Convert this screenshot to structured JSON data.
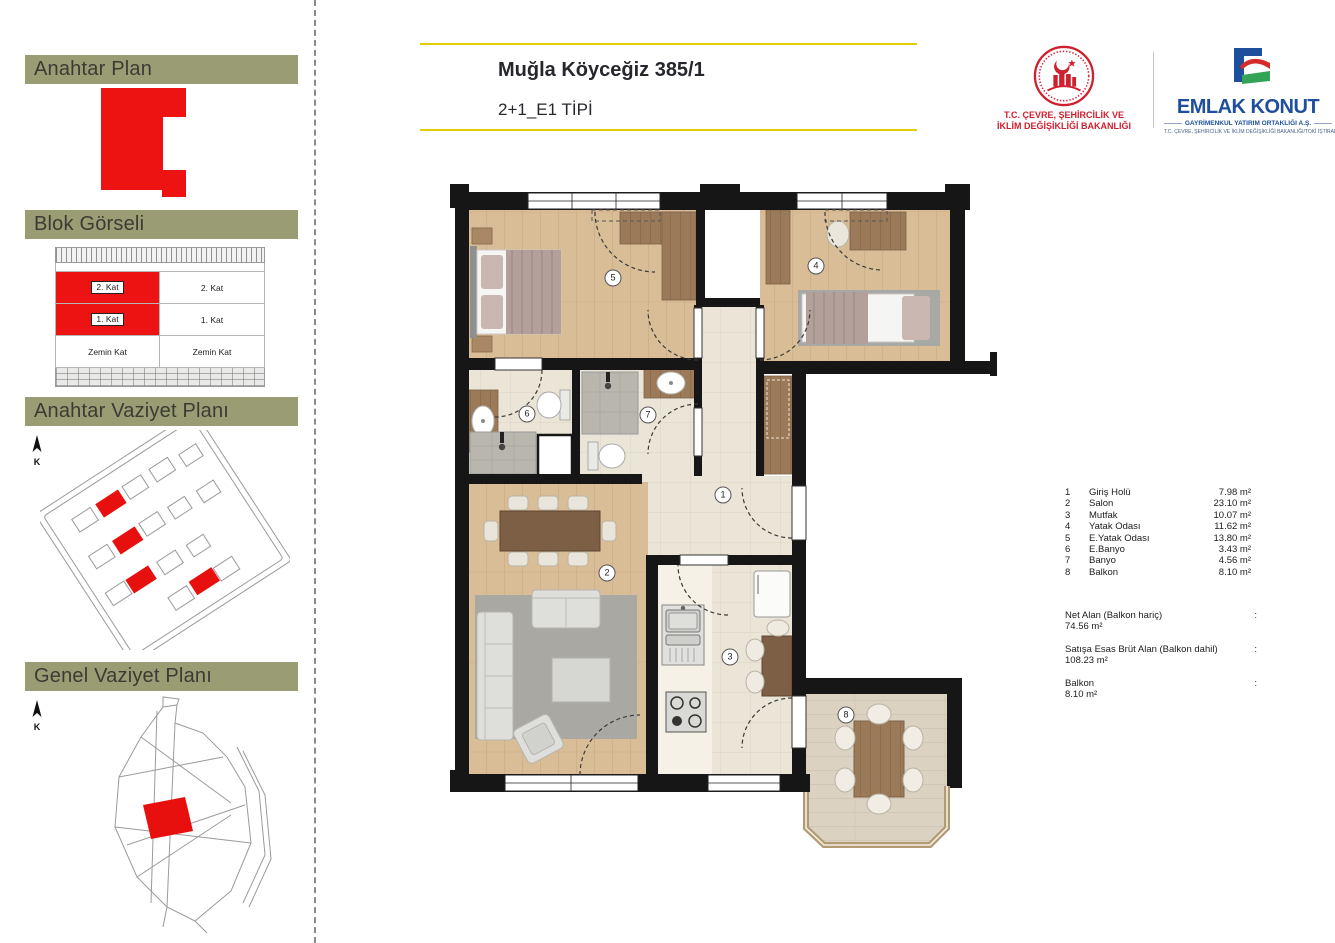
{
  "header": {
    "title": "Muğla Köyceğiz 385/1",
    "subtitle": "2+1_E1 TİPİ"
  },
  "logos": {
    "ministry": {
      "line1": "T.C. ÇEVRE, ŞEHİRCİLİK VE",
      "line2": "İKLİM DEĞİŞİKLİĞİ BAKANLIĞI"
    },
    "emlak": {
      "name": "EMLAK KONUT",
      "subtitle": "GAYRİMENKUL YATIRIM ORTAKLIĞI A.Ş.",
      "tagline": "T.C. ÇEVRE, ŞEHİRCİLİK VE İKLİM DEĞİŞİKLİĞİ BAKANLIĞI/TOKİ İŞTİRAKİDİR"
    }
  },
  "sidebar": {
    "north_label": "K",
    "sections": [
      {
        "title": "Anahtar Plan"
      },
      {
        "title": "Blok Görseli"
      },
      {
        "title": "Anahtar Vaziyet Planı"
      },
      {
        "title": "Genel Vaziyet Planı"
      }
    ],
    "blok": {
      "left_col": [
        "2. Kat",
        "1. Kat",
        "Zemin Kat"
      ],
      "right_col": [
        "2. Kat",
        "1. Kat",
        "Zemin Kat"
      ]
    }
  },
  "plan": {
    "markers": [
      {
        "num": "1"
      },
      {
        "num": "2"
      },
      {
        "num": "3"
      },
      {
        "num": "4"
      },
      {
        "num": "5"
      },
      {
        "num": "6"
      },
      {
        "num": "7"
      },
      {
        "num": "8"
      }
    ]
  },
  "legend": {
    "rows": [
      {
        "num": "1",
        "name": "Giriş Holü",
        "area": "7.98 m²"
      },
      {
        "num": "2",
        "name": "Salon",
        "area": "23.10 m²"
      },
      {
        "num": "3",
        "name": "Mutfak",
        "area": "10.07 m²"
      },
      {
        "num": "4",
        "name": "Yatak Odası",
        "area": "11.62 m²"
      },
      {
        "num": "5",
        "name": "E.Yatak Odası",
        "area": "13.80 m²"
      },
      {
        "num": "6",
        "name": "E.Banyo",
        "area": "3.43 m²"
      },
      {
        "num": "7",
        "name": "Banyo",
        "area": "4.56 m²"
      },
      {
        "num": "8",
        "name": "Balkon",
        "area": "8.10 m²"
      }
    ],
    "totals": [
      {
        "label": "Net Alan (Balkon  hariç)",
        "colon": ":",
        "value": "74.56 m²"
      },
      {
        "label": "Satışa Esas Brüt Alan (Balkon dahil)",
        "colon": ":",
        "value": "108.23 m²"
      },
      {
        "label": "Balkon",
        "colon": ":",
        "value": "8.10 m²"
      }
    ]
  },
  "colors": {
    "accent_yellow": "#e3cf00",
    "olive_header": "#9a9c74",
    "highlight_red": "#ee1313",
    "emlak_blue": "#1d4f9c",
    "ministry_red": "#cf2030"
  }
}
